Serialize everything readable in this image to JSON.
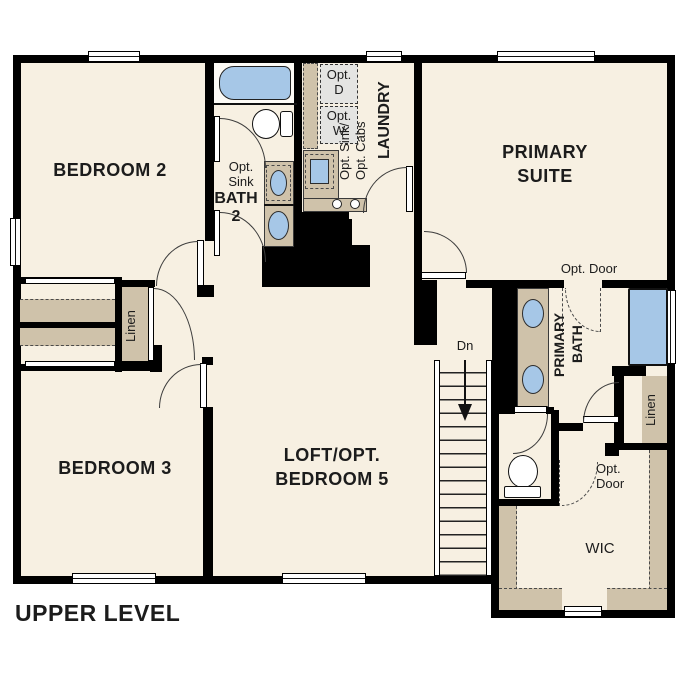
{
  "title": "UPPER LEVEL",
  "colors": {
    "floor": "#f7f0e2",
    "casework_tan": "#cfc2aa",
    "fixture_blue": "#a6c7e7",
    "appliance_gray": "#e4e4e2",
    "wall_black": "#000000"
  },
  "labels": {
    "bedroom2": "BEDROOM 2",
    "bedroom3": "BEDROOM 3",
    "primary_suite": [
      "PRIMARY",
      "SUITE"
    ],
    "loft": [
      "LOFT/OPT.",
      "BEDROOM 5"
    ],
    "bath2": [
      "BATH",
      "2"
    ],
    "bath2_opt_sink": [
      "Opt.",
      "Sink"
    ],
    "laundry": "LAUNDRY",
    "opt_dryer": [
      "Opt.",
      "D"
    ],
    "opt_washer": [
      "Opt.",
      "W"
    ],
    "laundry_opt": [
      "Opt. Sink/",
      "Opt. Cabs"
    ],
    "primary_bath": [
      "PRIMARY",
      "BATH"
    ],
    "opt_door_suite": "Opt. Door",
    "opt_door_wic": [
      "Opt.",
      "Door"
    ],
    "linen_hall": "Linen",
    "linen_primary": "Linen",
    "wic": "WIC",
    "stairs_down": "Dn"
  }
}
